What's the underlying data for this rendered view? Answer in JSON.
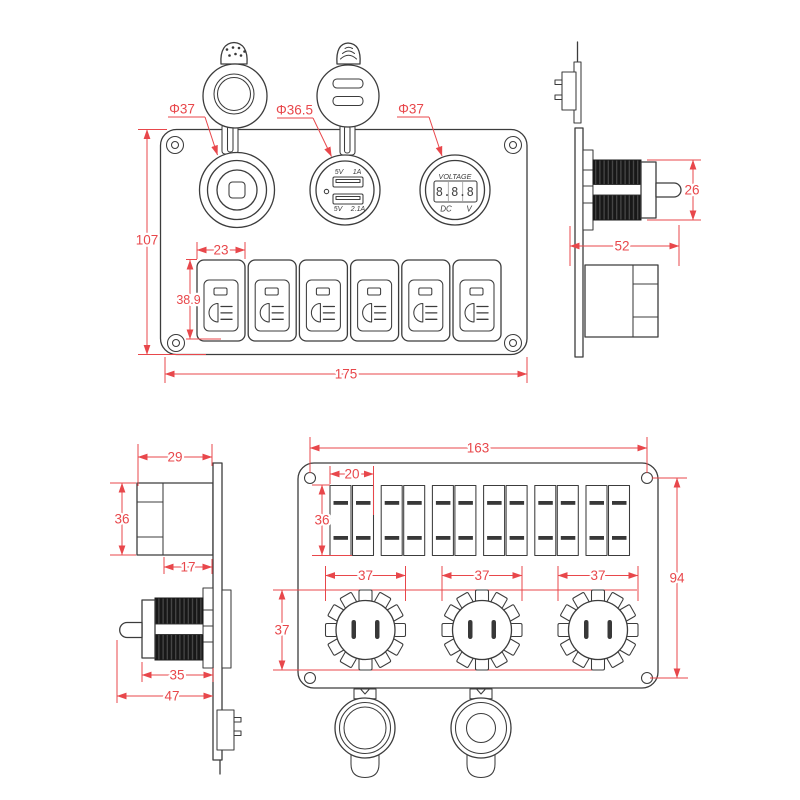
{
  "colors": {
    "line": "#3c3c3c",
    "dimension": "#e8474b",
    "background": "#ffffff",
    "thread_fill": "#181818"
  },
  "views": {
    "front": {
      "name": "panel front view",
      "labels": {
        "socket_dia": "Φ37",
        "usb_dia": "Φ36.5",
        "volt_dia": "Φ37",
        "height": "107",
        "switch_width": "23",
        "switch_height": "38.9",
        "width": "175"
      },
      "usb": {
        "top_volt": "5V",
        "top_amp": "1A",
        "bottom_volt": "5V",
        "bottom_amp": "2.1A"
      },
      "voltmeter": {
        "title": "VOLTAGE",
        "display": "8.8.8",
        "dc": "DC",
        "unit": "V"
      }
    },
    "side_right": {
      "name": "socket side view",
      "labels": {
        "pin": "26",
        "length": "52"
      }
    },
    "side_left": {
      "name": "switch and socket side view",
      "labels": {
        "depth": "29",
        "height": "36",
        "body": "17",
        "thread": "35",
        "total": "47"
      }
    },
    "back": {
      "name": "panel back view",
      "labels": {
        "width": "163",
        "cutout_width": "20",
        "cutout_height": "36",
        "socket_1": "37",
        "socket_2": "37",
        "socket_3": "37",
        "socket_height": "37",
        "height": "94"
      }
    }
  }
}
